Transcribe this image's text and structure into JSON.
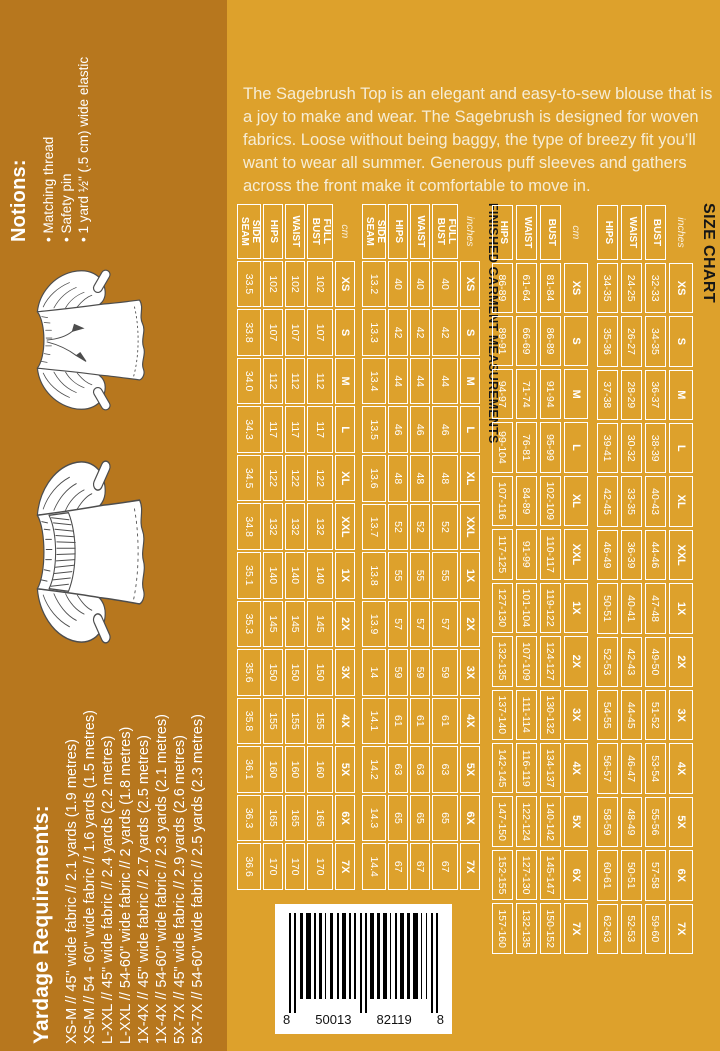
{
  "colors": {
    "background": "#DDA12C",
    "sidebar": "#B7771E",
    "table_lines": "#FFFFFF",
    "title_text": "#161616",
    "body_text": "#F6EDD6"
  },
  "description": "The Sagebrush Top is an elegant and easy-to-sew blouse that is a joy to make and wear. The Sagebrush is designed for woven fabrics. Loose without being baggy, the type of breezy fit you’ll want to wear all summer. Generous puff sleeves and gathers across the front make it comfortable to move in.",
  "notions": {
    "title": "Notions:",
    "items": [
      "Matching thread",
      "Safety pin",
      "1 yard ½\" (.5 cm) wide elastic"
    ]
  },
  "yardage": {
    "title": "Yardage Requirements:",
    "lines": [
      "XS-M // 45\" wide fabric // 2.1 yards (1.9 metres)",
      "XS-M // 54 - 60\" wide fabric // 1.6 yards (1.5 metres)",
      "L-XXL // 45\" wide fabric // 2.4 yards (2.2 metres)",
      "L-XXL // 54-60\" wide fabric // 2 yards (1.8 metres)",
      "1X-4X // 45\" wide fabric // 2.7 yards (2.5 metres)",
      "1X-4X // 54-60\" wide fabric // 2.3 yards (2.1 metres)",
      "5X-7X // 45\" wide fabric // 2.9 yards (2.6 metres)",
      "5X-7X // 54-60\" wide fabric // 2.5 yards (2.3 metres)"
    ]
  },
  "size_chart": {
    "title": "SIZE CHART",
    "sizes": [
      "XS",
      "S",
      "M",
      "L",
      "XL",
      "XXL",
      "1X",
      "2X",
      "3X",
      "4X",
      "5X",
      "6X",
      "7X"
    ],
    "tables": [
      {
        "unit": "inches",
        "rows": [
          {
            "label": "BUST",
            "values": [
              "32-33",
              "34-35",
              "36-37",
              "38-39",
              "40-43",
              "44-46",
              "47-48",
              "49-50",
              "51-52",
              "53-54",
              "55-56",
              "57-58",
              "59-60"
            ]
          },
          {
            "label": "WAIST",
            "values": [
              "24-25",
              "26-27",
              "28-29",
              "30-32",
              "33-35",
              "36-39",
              "40-41",
              "42-43",
              "44-45",
              "46-47",
              "48-49",
              "50-51",
              "52-53"
            ]
          },
          {
            "label": "HIPS",
            "values": [
              "34-35",
              "35-36",
              "37-38",
              "39-41",
              "42-45",
              "46-49",
              "50-51",
              "52-53",
              "54-55",
              "56-57",
              "58-59",
              "60-61",
              "62-63"
            ]
          }
        ]
      },
      {
        "unit": "cm",
        "rows": [
          {
            "label": "BUST",
            "values": [
              "81-84",
              "86-89",
              "91-94",
              "95-99",
              "102-109",
              "110-117",
              "119-122",
              "124-127",
              "130-132",
              "134-137",
              "140-142",
              "145-147",
              "150-152"
            ]
          },
          {
            "label": "WAIST",
            "values": [
              "61-64",
              "66-69",
              "71-74",
              "76-81",
              "84-89",
              "91-99",
              "101-104",
              "107-109",
              "111-114",
              "116-119",
              "122-124",
              "127-130",
              "132-135"
            ]
          },
          {
            "label": "HIPS",
            "values": [
              "86-89",
              "89-91",
              "94-97",
              "99-104",
              "107-116",
              "117-125",
              "127-130",
              "132-135",
              "137-140",
              "142-145",
              "147-150",
              "152-155",
              "157-160"
            ]
          }
        ]
      }
    ]
  },
  "finished_garment": {
    "title": "FINISHED GARMENT MEASUREMENTS",
    "sizes": [
      "XS",
      "S",
      "M",
      "L",
      "XL",
      "XXL",
      "1X",
      "2X",
      "3X",
      "4X",
      "5X",
      "6X",
      "7X"
    ],
    "tables": [
      {
        "unit": "inches",
        "rows": [
          {
            "label": "FULL BUST",
            "values": [
              "40",
              "42",
              "44",
              "46",
              "48",
              "52",
              "55",
              "57",
              "59",
              "61",
              "63",
              "65",
              "67"
            ]
          },
          {
            "label": "WAIST",
            "values": [
              "40",
              "42",
              "44",
              "46",
              "48",
              "52",
              "55",
              "57",
              "59",
              "61",
              "63",
              "65",
              "67"
            ]
          },
          {
            "label": "HIPS",
            "values": [
              "40",
              "42",
              "44",
              "46",
              "48",
              "52",
              "55",
              "57",
              "59",
              "61",
              "63",
              "65",
              "67"
            ]
          },
          {
            "label": "SIDE SEAM",
            "values": [
              "13.2",
              "13.3",
              "13.4",
              "13.5",
              "13.6",
              "13.7",
              "13.8",
              "13.9",
              "14",
              "14.1",
              "14.2",
              "14.3",
              "14.4"
            ]
          }
        ]
      },
      {
        "unit": "cm",
        "rows": [
          {
            "label": "FULL BUST",
            "values": [
              "102",
              "107",
              "112",
              "117",
              "122",
              "132",
              "140",
              "145",
              "150",
              "155",
              "160",
              "165",
              "170"
            ]
          },
          {
            "label": "WAIST",
            "values": [
              "102",
              "107",
              "112",
              "117",
              "122",
              "132",
              "140",
              "145",
              "150",
              "155",
              "160",
              "165",
              "170"
            ]
          },
          {
            "label": "HIPS",
            "values": [
              "102",
              "107",
              "112",
              "117",
              "122",
              "132",
              "140",
              "145",
              "150",
              "155",
              "160",
              "165",
              "170"
            ]
          },
          {
            "label": "SIDE SEAM",
            "values": [
              "33.5",
              "33.8",
              "34.0",
              "34.3",
              "34.5",
              "34.8",
              "35.1",
              "35.3",
              "35.6",
              "35.8",
              "36.1",
              "36.3",
              "36.6"
            ]
          }
        ]
      }
    ]
  },
  "barcode": {
    "digit_groups": [
      "8",
      "50013",
      "82119",
      "8"
    ]
  }
}
